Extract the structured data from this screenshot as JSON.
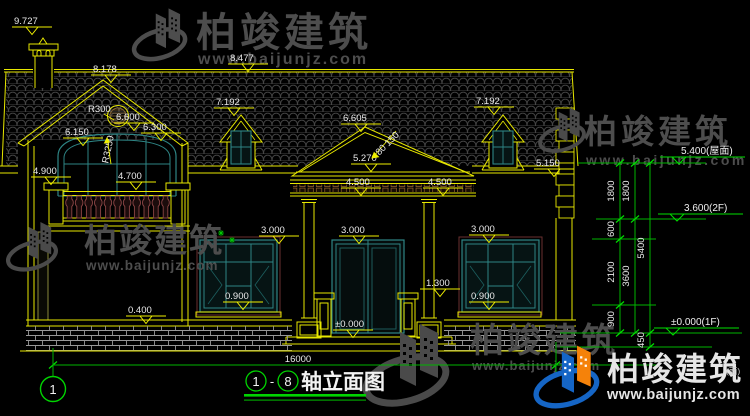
{
  "drawing": {
    "title_axis_start": "1",
    "title_axis_dash": "-",
    "title_axis_end": "8",
    "title_text": "轴立面图",
    "axis_bubble_left": "1"
  },
  "watermark": {
    "brand": "柏竣建筑",
    "url": "www.baijunjz.com"
  },
  "markers": {
    "chimney_top": "9.727",
    "left_gable_ridge": "8.178",
    "main_ridge": "8.477",
    "left_dormer": "7.192",
    "right_dormer": "7.192",
    "round_window": "R300",
    "gable_center": "6.600",
    "left_gable_eave": "6.150",
    "right_gable_eave": "6.300",
    "arch_radius": "R3250",
    "pediment_apex": "6.605",
    "pediment_base": "5.270",
    "slope_rise": "150",
    "slope_run": "80",
    "entablature_left": "4.500",
    "entablature_right": "4.500",
    "left_wing_eave": "4.900",
    "balcony_rail": "4.700",
    "main_eave": "5.150",
    "left_window_head": "3.000",
    "door_head": "3.000",
    "right_window_head": "3.000",
    "left_window_sill": "0.900",
    "right_window_sill": "0.900",
    "plinth_top": "0.400",
    "porch_rail_post": "1.300",
    "entry_level": "±0.000",
    "ground_label_fragment": "(面)"
  },
  "levels": {
    "roof": "5.400(屋面)",
    "floor2": "3.600(2F)",
    "floor1": "±0.000(1F)"
  },
  "dims": {
    "total_width": "16000",
    "inner_chain": [
      "1800",
      "600",
      "2100",
      "900"
    ],
    "mid_chain": [
      "1800",
      "3600"
    ],
    "outer_chain": [
      "5400",
      "450"
    ]
  }
}
